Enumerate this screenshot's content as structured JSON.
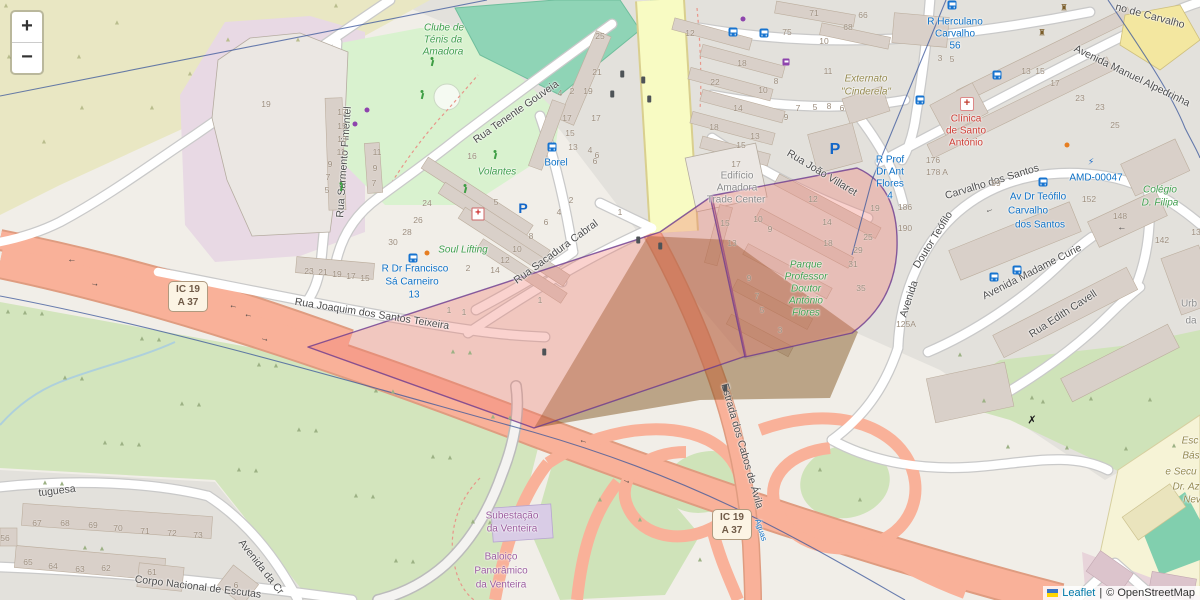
{
  "controls": {
    "zoom_in_label": "+",
    "zoom_out_label": "−"
  },
  "attribution": {
    "leaflet_label": "Leaflet",
    "separator": "|",
    "osm_label": "© OpenStreetMap"
  },
  "colors": {
    "overlay_fill": "#f07a6e",
    "overlay_stroke": "#6b3a8e",
    "tan_fill": "#7a4a12",
    "trunk": "#f9b199",
    "secondary": "#f8fbc3",
    "admin_boundary": "#39569b",
    "transit_blue": "#0d70c5",
    "poi_green": "#3f9e4d",
    "poi_purple": "#9a5b9e",
    "poi_red": "#cc3b33",
    "link_blue": "#0078a8"
  },
  "shields": [
    {
      "x": 168,
      "y": 281,
      "l1": "IC 19",
      "l2": "A 37"
    },
    {
      "x": 712,
      "y": 509,
      "l1": "IC 19",
      "l2": "A 37"
    }
  ],
  "labels": [
    {
      "n": "street-rua-sarmento-pimentel",
      "c": "street",
      "t": "Rua Sarmento Pimentel",
      "x": 344,
      "y": 162,
      "r": -86
    },
    {
      "n": "street-rua-tenente-gouveia",
      "c": "street",
      "t": "Rua Tenente Gouveia",
      "x": 516,
      "y": 112,
      "r": -35
    },
    {
      "n": "street-rua-joaquim-dos-santos-teixeira",
      "c": "street",
      "t": "Rua Joaquim dos Santos Teixeira",
      "x": 372,
      "y": 314,
      "r": 9
    },
    {
      "n": "street-rua-sacadura-cabral",
      "c": "street",
      "t": "Rua Sacadura Cabral",
      "x": 556,
      "y": 252,
      "r": -36
    },
    {
      "n": "street-rua-joao-villaret",
      "c": "street",
      "t": "Rua João Villaret",
      "x": 822,
      "y": 173,
      "r": 31
    },
    {
      "n": "street-avenida-manuel-alpedrinha",
      "c": "street",
      "t": "Avenida Manuel Alpedrinha",
      "x": 1132,
      "y": 76,
      "r": 26
    },
    {
      "n": "street-de-carvalho-partial",
      "c": "street",
      "t": "no de Carvalho",
      "x": 1150,
      "y": 16,
      "r": 15
    },
    {
      "n": "street-avenida-doutor-teofilo-1",
      "c": "street",
      "t": "Avenida",
      "x": 909,
      "y": 299,
      "r": -72
    },
    {
      "n": "street-avenida-doutor-teofilo-2",
      "c": "street",
      "t": "Doutor Teófilo",
      "x": 933,
      "y": 240,
      "r": -58
    },
    {
      "n": "street-avenida-doutor-teofilo-3",
      "c": "street",
      "t": "Carvalho dos Santos",
      "x": 992,
      "y": 182,
      "r": -17
    },
    {
      "n": "street-avenida-madame-curie",
      "c": "street",
      "t": "Avenida Madame Curie",
      "x": 1032,
      "y": 272,
      "r": -27
    },
    {
      "n": "street-rua-edith-cavell",
      "c": "street",
      "t": "Rua Edith Cavell",
      "x": 1063,
      "y": 314,
      "r": -33
    },
    {
      "n": "street-estrada-dos-cabos-de-avila",
      "c": "street",
      "t": "Estrada dos Cabos de Ávila",
      "x": 742,
      "y": 446,
      "r": 74
    },
    {
      "n": "street-corpo-nacional-de-escutas",
      "c": "street",
      "t": "Corpo Nacional de Escutas",
      "x": 198,
      "y": 587,
      "r": 7
    },
    {
      "n": "street-tuguesa-partial",
      "c": "street",
      "t": "tuguesa",
      "x": 57,
      "y": 491,
      "r": -7
    },
    {
      "n": "street-avenida-da-cr-partial",
      "c": "street",
      "t": "Avenida da Cr",
      "x": 261,
      "y": 567,
      "r": 52
    },
    {
      "n": "transit-borel",
      "c": "transit",
      "t": "Borel",
      "x": 556,
      "y": 163
    },
    {
      "n": "transit-sa-carneiro-1",
      "c": "transit",
      "t": "R Dr Francisco",
      "x": 415,
      "y": 269
    },
    {
      "n": "transit-sa-carneiro-2",
      "c": "transit",
      "t": "Sá Carneiro",
      "x": 412,
      "y": 282
    },
    {
      "n": "transit-sa-carneiro-3",
      "c": "transit",
      "t": "13",
      "x": 414,
      "y": 295
    },
    {
      "n": "transit-herculano-1",
      "c": "transit",
      "t": "R Herculano",
      "x": 955,
      "y": 22
    },
    {
      "n": "transit-herculano-2",
      "c": "transit",
      "t": "Carvalho",
      "x": 955,
      "y": 34
    },
    {
      "n": "transit-herculano-3",
      "c": "transit",
      "t": "56",
      "x": 955,
      "y": 46
    },
    {
      "n": "transit-prof-flores-1",
      "c": "transit",
      "t": "R Prof",
      "x": 890,
      "y": 160
    },
    {
      "n": "transit-prof-flores-2",
      "c": "transit",
      "t": "Dr Ant",
      "x": 890,
      "y": 172
    },
    {
      "n": "transit-prof-flores-3",
      "c": "transit",
      "t": "Flores",
      "x": 890,
      "y": 184
    },
    {
      "n": "transit-prof-flores-4",
      "c": "transit",
      "t": "4",
      "x": 890,
      "y": 196
    },
    {
      "n": "transit-av-teofilo-1",
      "c": "transit",
      "t": "Av Dr Teófilo",
      "x": 1038,
      "y": 197
    },
    {
      "n": "transit-av-teofilo-2",
      "c": "transit",
      "t": "Carvalho",
      "x": 1028,
      "y": 211
    },
    {
      "n": "transit-av-teofilo-3",
      "c": "transit",
      "t": "dos Santos",
      "x": 1040,
      "y": 225
    },
    {
      "n": "transit-amd-00047",
      "c": "transit",
      "t": "AMD-00047",
      "x": 1096,
      "y": 178
    },
    {
      "n": "transit-aguas-partial",
      "c": "transit-sm",
      "t": "Águas",
      "x": 761,
      "y": 530,
      "r": 72
    },
    {
      "n": "poi-clube-tenis-1",
      "c": "poi-green",
      "t": "Clube de",
      "x": 444,
      "y": 28
    },
    {
      "n": "poi-clube-tenis-2",
      "c": "poi-green",
      "t": "Ténis da",
      "x": 443,
      "y": 40
    },
    {
      "n": "poi-clube-tenis-3",
      "c": "poi-green",
      "t": "Amadora",
      "x": 443,
      "y": 52
    },
    {
      "n": "poi-volantes",
      "c": "poi-green",
      "t": "Volantes",
      "x": 497,
      "y": 172
    },
    {
      "n": "poi-soul-lifting",
      "c": "poi-green",
      "t": "Soul Lifting",
      "x": 463,
      "y": 250
    },
    {
      "n": "poi-parque-flores-1",
      "c": "poi-green",
      "t": "Parque",
      "x": 806,
      "y": 265
    },
    {
      "n": "poi-parque-flores-2",
      "c": "poi-green",
      "t": "Professor",
      "x": 806,
      "y": 277
    },
    {
      "n": "poi-parque-flores-3",
      "c": "poi-green",
      "t": "Doutor",
      "x": 806,
      "y": 289
    },
    {
      "n": "poi-parque-flores-4",
      "c": "poi-green",
      "t": "António",
      "x": 806,
      "y": 301
    },
    {
      "n": "poi-parque-flores-5",
      "c": "poi-green",
      "t": "Flores",
      "x": 806,
      "y": 313
    },
    {
      "n": "poi-colegio-filipa-1",
      "c": "poi-green",
      "t": "Colégio",
      "x": 1160,
      "y": 190
    },
    {
      "n": "poi-colegio-filipa-2",
      "c": "poi-green",
      "t": "D. Filipa",
      "x": 1160,
      "y": 203
    },
    {
      "n": "poi-subestacao-1",
      "c": "poi-purple",
      "t": "Subestação",
      "x": 512,
      "y": 516
    },
    {
      "n": "poi-subestacao-2",
      "c": "poi-purple",
      "t": "da Venteira",
      "x": 512,
      "y": 529
    },
    {
      "n": "poi-baloico-1",
      "c": "poi-purple",
      "t": "Baloiço",
      "x": 501,
      "y": 557
    },
    {
      "n": "poi-baloico-2",
      "c": "poi-purple",
      "t": "Panorâmico",
      "x": 501,
      "y": 571
    },
    {
      "n": "poi-balo-3",
      "c": "poi-purple",
      "t": "da Venteira",
      "x": 501,
      "y": 585
    },
    {
      "n": "poi-edificio-amadora-1",
      "c": "poi-gray",
      "t": "Edifício",
      "x": 737,
      "y": 176
    },
    {
      "n": "poi-edificio-amadora-2",
      "c": "poi-gray",
      "t": "Amadora",
      "x": 737,
      "y": 188
    },
    {
      "n": "poi-edificio-amadora-3",
      "c": "poi-gray",
      "t": "Trade Center",
      "x": 736,
      "y": 200
    },
    {
      "n": "poi-urb-1",
      "c": "poi-gray",
      "t": "Urb",
      "x": 1189,
      "y": 304
    },
    {
      "n": "poi-urb-2",
      "c": "poi-gray",
      "t": "da",
      "x": 1191,
      "y": 321
    },
    {
      "n": "poi-externato-1",
      "c": "poi-olive",
      "t": "Externato",
      "x": 866,
      "y": 79
    },
    {
      "n": "poi-externato-2",
      "c": "poi-olive",
      "t": "\"Cinderela\"",
      "x": 866,
      "y": 92
    },
    {
      "n": "poi-escola-1",
      "c": "poi-olive",
      "t": "Esc",
      "x": 1190,
      "y": 441
    },
    {
      "n": "poi-escola-2",
      "c": "poi-olive",
      "t": "Bás",
      "x": 1191,
      "y": 456
    },
    {
      "n": "poi-escola-3",
      "c": "poi-olive",
      "t": "e Secu",
      "x": 1181,
      "y": 472
    },
    {
      "n": "poi-escola-4",
      "c": "poi-olive",
      "t": "Dr. Az",
      "x": 1186,
      "y": 487
    },
    {
      "n": "poi-escola-5",
      "c": "poi-olive",
      "t": "Nev",
      "x": 1192,
      "y": 500
    },
    {
      "n": "poi-clinica-1",
      "c": "poi-red",
      "t": "Clínica",
      "x": 966,
      "y": 119
    },
    {
      "n": "poi-clinica-2",
      "c": "poi-red",
      "t": "de Santo",
      "x": 966,
      "y": 131
    },
    {
      "n": "poi-clinica-3",
      "c": "poi-red",
      "t": "António",
      "x": 966,
      "y": 143
    }
  ],
  "house_numbers": [
    [
      342,
      112,
      "17"
    ],
    [
      342,
      126,
      "15"
    ],
    [
      342,
      139,
      "13"
    ],
    [
      341,
      152,
      "11"
    ],
    [
      330,
      164,
      "9"
    ],
    [
      328,
      177,
      "7"
    ],
    [
      327,
      190,
      "5"
    ],
    [
      309,
      271,
      "23"
    ],
    [
      323,
      272,
      "21"
    ],
    [
      337,
      274,
      "19"
    ],
    [
      351,
      276,
      "17"
    ],
    [
      365,
      278,
      "15"
    ],
    [
      377,
      152,
      "11"
    ],
    [
      375,
      168,
      "9"
    ],
    [
      374,
      183,
      "7"
    ],
    [
      266,
      104,
      "19"
    ],
    [
      600,
      36,
      "25"
    ],
    [
      597,
      72,
      "21"
    ],
    [
      588,
      91,
      "19"
    ],
    [
      572,
      91,
      "2"
    ],
    [
      560,
      93,
      "4"
    ],
    [
      596,
      118,
      "17"
    ],
    [
      567,
      118,
      "17"
    ],
    [
      570,
      133,
      "15"
    ],
    [
      573,
      147,
      "13"
    ],
    [
      590,
      150,
      "4"
    ],
    [
      595,
      161,
      "6"
    ],
    [
      472,
      156,
      "16"
    ],
    [
      496,
      202,
      "5"
    ],
    [
      427,
      203,
      "24"
    ],
    [
      418,
      220,
      "26"
    ],
    [
      407,
      232,
      "28"
    ],
    [
      393,
      242,
      "30"
    ],
    [
      468,
      268,
      "2"
    ],
    [
      495,
      270,
      "14"
    ],
    [
      505,
      260,
      "12"
    ],
    [
      517,
      249,
      "10"
    ],
    [
      531,
      236,
      "8"
    ],
    [
      546,
      222,
      "6"
    ],
    [
      559,
      212,
      "4"
    ],
    [
      571,
      200,
      "2"
    ],
    [
      597,
      155,
      "6"
    ],
    [
      620,
      212,
      "1"
    ],
    [
      449,
      310,
      "1"
    ],
    [
      464,
      312,
      "1"
    ],
    [
      540,
      300,
      "1"
    ],
    [
      690,
      33,
      "12"
    ],
    [
      742,
      63,
      "18"
    ],
    [
      715,
      82,
      "22"
    ],
    [
      763,
      90,
      "10"
    ],
    [
      776,
      81,
      "8"
    ],
    [
      738,
      108,
      "14"
    ],
    [
      714,
      127,
      "18"
    ],
    [
      755,
      136,
      "13"
    ],
    [
      741,
      145,
      "15"
    ],
    [
      736,
      164,
      "17"
    ],
    [
      786,
      117,
      "9"
    ],
    [
      798,
      108,
      "7"
    ],
    [
      815,
      107,
      "5"
    ],
    [
      829,
      106,
      "8"
    ],
    [
      842,
      108,
      "6"
    ],
    [
      814,
      13,
      "71"
    ],
    [
      787,
      32,
      "75"
    ],
    [
      863,
      15,
      "66"
    ],
    [
      848,
      27,
      "68"
    ],
    [
      824,
      41,
      "10"
    ],
    [
      828,
      71,
      "11"
    ],
    [
      725,
      223,
      "15"
    ],
    [
      732,
      243,
      "13"
    ],
    [
      813,
      199,
      "12"
    ],
    [
      758,
      219,
      "10"
    ],
    [
      770,
      229,
      "9"
    ],
    [
      827,
      222,
      "14"
    ],
    [
      828,
      243,
      "18"
    ],
    [
      749,
      278,
      "9"
    ],
    [
      757,
      296,
      "7"
    ],
    [
      762,
      310,
      "5"
    ],
    [
      780,
      330,
      "3"
    ],
    [
      875,
      208,
      "19"
    ],
    [
      868,
      237,
      "25"
    ],
    [
      858,
      250,
      "29"
    ],
    [
      853,
      264,
      "31"
    ],
    [
      861,
      288,
      "35"
    ],
    [
      905,
      207,
      "186"
    ],
    [
      905,
      228,
      "190"
    ],
    [
      940,
      58,
      "3"
    ],
    [
      952,
      59,
      "5"
    ],
    [
      1026,
      71,
      "13"
    ],
    [
      1040,
      71,
      "15"
    ],
    [
      1055,
      83,
      "17"
    ],
    [
      1080,
      98,
      "23"
    ],
    [
      1100,
      107,
      "23"
    ],
    [
      1115,
      125,
      "25"
    ],
    [
      933,
      160,
      "176"
    ],
    [
      937,
      172,
      "178 A"
    ],
    [
      996,
      183,
      "99"
    ],
    [
      1089,
      199,
      "152"
    ],
    [
      1120,
      216,
      "148"
    ],
    [
      1162,
      240,
      "142"
    ],
    [
      1196,
      232,
      "13"
    ],
    [
      906,
      324,
      "125A"
    ],
    [
      37,
      523,
      "67"
    ],
    [
      65,
      523,
      "68"
    ],
    [
      93,
      525,
      "69"
    ],
    [
      118,
      528,
      "70"
    ],
    [
      145,
      531,
      "71"
    ],
    [
      172,
      533,
      "72"
    ],
    [
      198,
      535,
      "73"
    ],
    [
      28,
      562,
      "65"
    ],
    [
      53,
      566,
      "64"
    ],
    [
      80,
      569,
      "63"
    ],
    [
      106,
      568,
      "62"
    ],
    [
      152,
      572,
      "61"
    ],
    [
      5,
      538,
      "56"
    ],
    [
      236,
      585,
      "6"
    ]
  ],
  "icons": [
    {
      "n": "bus-stop-icon",
      "k": "bus",
      "x": 552,
      "y": 147
    },
    {
      "n": "bus-stop-icon",
      "k": "bus",
      "x": 952,
      "y": 5
    },
    {
      "n": "bus-stop-icon",
      "k": "bus",
      "x": 413,
      "y": 258
    },
    {
      "n": "bus-stop-icon",
      "k": "bus",
      "x": 733,
      "y": 32
    },
    {
      "n": "bus-stop-icon",
      "k": "bus",
      "x": 764,
      "y": 33
    },
    {
      "n": "bus-stop-icon",
      "k": "bus",
      "x": 920,
      "y": 100
    },
    {
      "n": "bus-stop-icon",
      "k": "bus",
      "x": 994,
      "y": 277
    },
    {
      "n": "bus-stop-icon",
      "k": "bus",
      "x": 1017,
      "y": 270
    },
    {
      "n": "bus-stop-icon",
      "k": "bus",
      "x": 1043,
      "y": 182
    },
    {
      "n": "bus-stop-icon",
      "k": "bus",
      "x": 997,
      "y": 75
    },
    {
      "n": "parking-icon",
      "k": "pk",
      "x": 523,
      "y": 208,
      "s": 14,
      "g": "P"
    },
    {
      "n": "parking-icon",
      "k": "pk",
      "x": 835,
      "y": 150,
      "s": 16,
      "g": "P"
    },
    {
      "n": "pharmacy-icon",
      "k": "ph",
      "x": 478,
      "y": 214,
      "g": "+"
    },
    {
      "n": "hospital-icon",
      "k": "hosp",
      "x": 967,
      "y": 104,
      "g": "+"
    },
    {
      "n": "charging-station-icon",
      "k": "glyph",
      "x": 1091,
      "y": 162,
      "g": "⚡",
      "col": "#1467c8",
      "s": 9
    },
    {
      "n": "supermarket-icon",
      "k": "cart",
      "x": 786,
      "y": 62
    },
    {
      "n": "bank-icon",
      "k": "glyph",
      "x": 1064,
      "y": 8,
      "g": "♜",
      "col": "#7a5c28",
      "s": 9
    },
    {
      "n": "bank-icon",
      "k": "glyph",
      "x": 1042,
      "y": 33,
      "g": "♜",
      "col": "#7a5c28",
      "s": 9
    },
    {
      "n": "windmill-icon",
      "k": "glyph",
      "x": 1032,
      "y": 420,
      "g": "✗",
      "col": "#1a1a1a",
      "s": 11
    },
    {
      "n": "runner-icon",
      "k": "person",
      "x": 495,
      "y": 155
    },
    {
      "n": "runner-icon",
      "k": "person",
      "x": 465,
      "y": 189
    },
    {
      "n": "playground-icon",
      "k": "person",
      "x": 432,
      "y": 62
    },
    {
      "n": "playground-icon",
      "k": "person",
      "x": 422,
      "y": 95
    },
    {
      "n": "playground-icon",
      "k": "person",
      "x": 341,
      "y": 187
    },
    {
      "n": "traffic-light-icon",
      "k": "tl",
      "x": 622,
      "y": 74
    },
    {
      "n": "traffic-light-icon",
      "k": "tl",
      "x": 643,
      "y": 80
    },
    {
      "n": "traffic-light-icon",
      "k": "tl",
      "x": 612,
      "y": 94
    },
    {
      "n": "traffic-light-icon",
      "k": "tl",
      "x": 649,
      "y": 99
    },
    {
      "n": "traffic-light-icon",
      "k": "tl",
      "x": 638,
      "y": 240
    },
    {
      "n": "traffic-light-icon",
      "k": "tl",
      "x": 660,
      "y": 246
    },
    {
      "n": "traffic-light-icon",
      "k": "tl",
      "x": 544,
      "y": 352
    },
    {
      "n": "traffic-light-icon",
      "k": "tl",
      "x": 725,
      "y": 388
    },
    {
      "n": "oneway-arrow-icon",
      "k": "arrow",
      "x": 72,
      "y": 262,
      "g": "→",
      "r": 180
    },
    {
      "n": "oneway-arrow-icon",
      "k": "arrow",
      "x": 95,
      "y": 283,
      "g": "→",
      "r": 10
    },
    {
      "n": "oneway-arrow-icon",
      "k": "arrow",
      "x": 233,
      "y": 308,
      "g": "→",
      "r": 190
    },
    {
      "n": "oneway-arrow-icon",
      "k": "arrow",
      "x": 248,
      "y": 317,
      "g": "→",
      "r": 190
    },
    {
      "n": "oneway-arrow-icon",
      "k": "arrow",
      "x": 265,
      "y": 338,
      "g": "→",
      "r": 15
    },
    {
      "n": "oneway-arrow-icon",
      "k": "arrow",
      "x": 1122,
      "y": 230,
      "g": "→",
      "r": 180
    },
    {
      "n": "oneway-arrow-icon",
      "k": "arrow",
      "x": 990,
      "y": 212,
      "g": "→",
      "r": 160
    },
    {
      "n": "oneway-arrow-icon",
      "k": "arrow",
      "x": 583,
      "y": 443,
      "g": "→",
      "r": 195
    },
    {
      "n": "oneway-arrow-icon",
      "k": "arrow",
      "x": 627,
      "y": 480,
      "g": "→",
      "r": 20
    },
    {
      "n": "poi-dot-icon",
      "k": "dot",
      "x": 743,
      "y": 19,
      "col": "#8e44ad"
    },
    {
      "n": "poi-dot-icon",
      "k": "dot",
      "x": 355,
      "y": 124,
      "col": "#8e44ad"
    },
    {
      "n": "poi-dot-icon",
      "k": "dot",
      "x": 367,
      "y": 110,
      "col": "#8e44ad"
    },
    {
      "n": "poi-dot-icon",
      "k": "dot",
      "x": 1067,
      "y": 145,
      "col": "#e67e22"
    },
    {
      "n": "poi-dot-icon",
      "k": "dot",
      "x": 427,
      "y": 253,
      "col": "#e67e22"
    }
  ]
}
